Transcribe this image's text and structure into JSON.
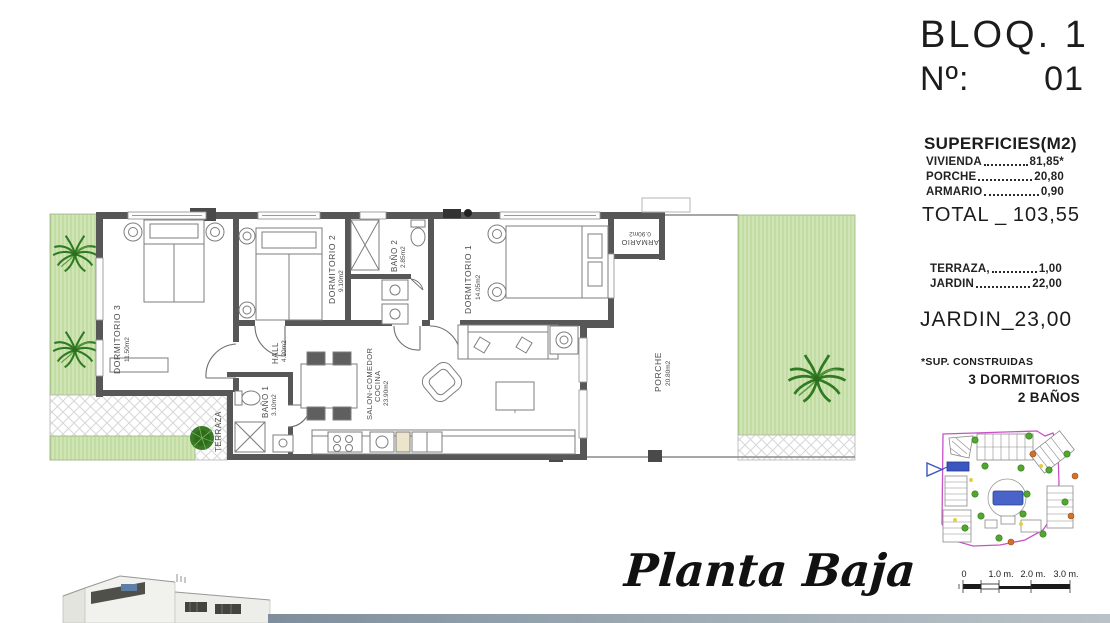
{
  "header": {
    "block": "BLOQ. 1",
    "unit_label": "Nº:",
    "unit_value": "01"
  },
  "surfaces": {
    "title": "SUPERFICIES(M2)",
    "rows": [
      {
        "label": "VIVIENDA",
        "value": "81,85*"
      },
      {
        "label": "PORCHE",
        "value": "20,80"
      },
      {
        "label": "ARMARIO",
        "value": "0,90"
      }
    ],
    "total": {
      "label": "TOTAL",
      "sep": "_",
      "value": "103,55"
    },
    "outdoor_rows": [
      {
        "label": "TERRAZA,",
        "value": "1,00"
      },
      {
        "label": "JARDIN",
        "value": "22,00"
      }
    ],
    "jardin_total": {
      "label": "JARDIN",
      "sep": "_",
      "value": "23,00"
    },
    "footnote": "*SUP. CONSTRUIDAS",
    "program": [
      "3 DORMITORIOS",
      "2 BAÑOS"
    ]
  },
  "plan": {
    "caption": "Planta Baja",
    "rooms": {
      "dorm3": {
        "name": "DORMITORIO 3",
        "area": "11.50m2"
      },
      "dorm2": {
        "name": "DORMITORIO 2",
        "area": "9.10m2"
      },
      "bano2": {
        "name": "BAÑO 2",
        "area": "2.85m2"
      },
      "dorm1": {
        "name": "DORMITORIO 1",
        "area": "14.05m2"
      },
      "hall": {
        "name": "HALL",
        "area": "4.20m2"
      },
      "bano1": {
        "name": "BAÑO 1",
        "area": "3.10m2"
      },
      "salon": {
        "name": "SALON-COMEDOR",
        "name2": "COCINA",
        "area": "23.90m2"
      },
      "terraza": {
        "name": "TERRAZA"
      },
      "porche": {
        "name": "PORCHE",
        "area": "20.80m2"
      },
      "armario": {
        "name": "ARMARIO",
        "area": "0.90m2"
      }
    }
  },
  "scale_bar": {
    "labels": [
      "0",
      "1.0 m.",
      "2.0 m.",
      "3.0 m."
    ]
  },
  "colors": {
    "wall": "#575757",
    "garden_green": "#cfe5b5",
    "palm_green": "#2f7a22",
    "boundary_magenta": "#c753c7",
    "pool_blue": "#4a63c8",
    "highlight_blue": "#3a57c0"
  }
}
